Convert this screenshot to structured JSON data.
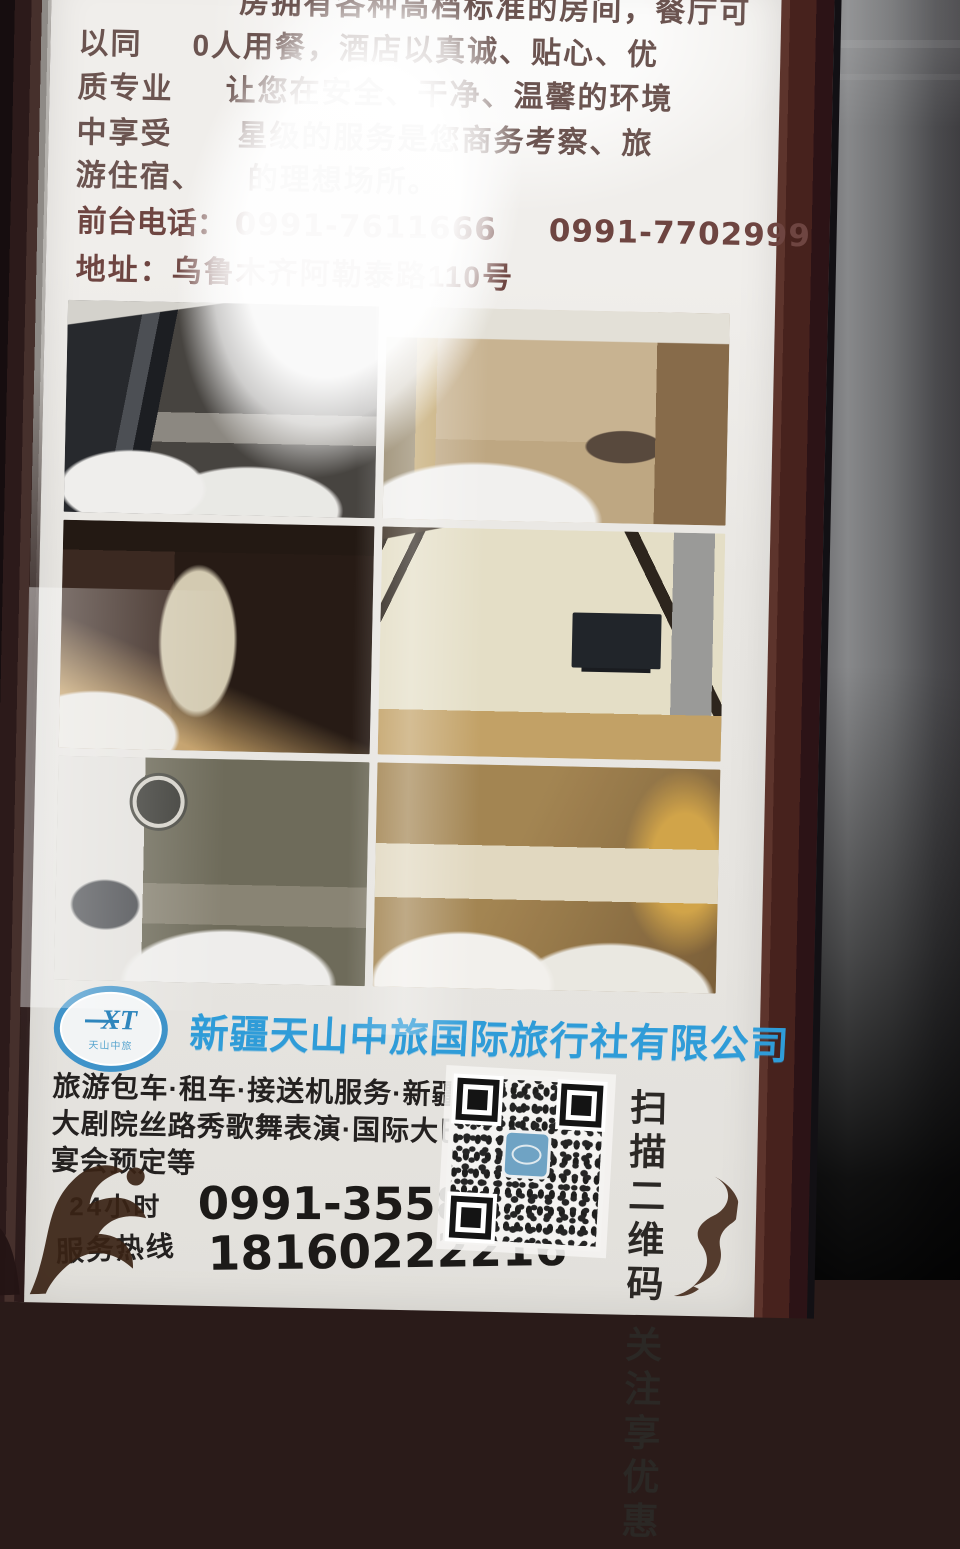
{
  "poster": {
    "intro_lines": [
      {
        "left": "",
        "right": "房拥有各种高档标准的房间，餐厅可"
      },
      {
        "left": "以同",
        "right": "0人用餐，酒店以真诚、贴心、优"
      },
      {
        "left": "质专业",
        "right": "让您在安全、干净、温馨的环境"
      },
      {
        "left": "中享受",
        "right": "星级的服务是您商务考察、旅"
      },
      {
        "left": "游住宿、",
        "right": "的理想场所。"
      }
    ],
    "front_desk": {
      "label": "前台电话：",
      "phone1": "0991-7611666",
      "phone2": "0991-7702999"
    },
    "address": {
      "label": "地址：",
      "value": "乌鲁木齐阿勒泰路110号"
    },
    "agency": {
      "logo_text": "XT",
      "logo_subtext": "天山中旅",
      "name": "新疆天山中旅国际旅行社有限公司"
    },
    "services_lines": [
      "旅游包车·租车·接送机服务·新疆",
      "大剧院丝路秀歌舞表演·国际大巴扎",
      "宴会预定等"
    ],
    "hotline": {
      "label_line1": "24小时",
      "label_line2": "服务热线",
      "phone1": "0991-3558811",
      "phone2": "18160222216"
    },
    "qr": {
      "caption_right": "扫描二维码",
      "caption_left": "关注享优惠"
    },
    "colors": {
      "accent_blue": "#2f9cd8",
      "maroon_text": "#6e4541",
      "black_text": "#242120",
      "frame_brown": "#47221d",
      "metal_gray": "#87888a"
    }
  }
}
